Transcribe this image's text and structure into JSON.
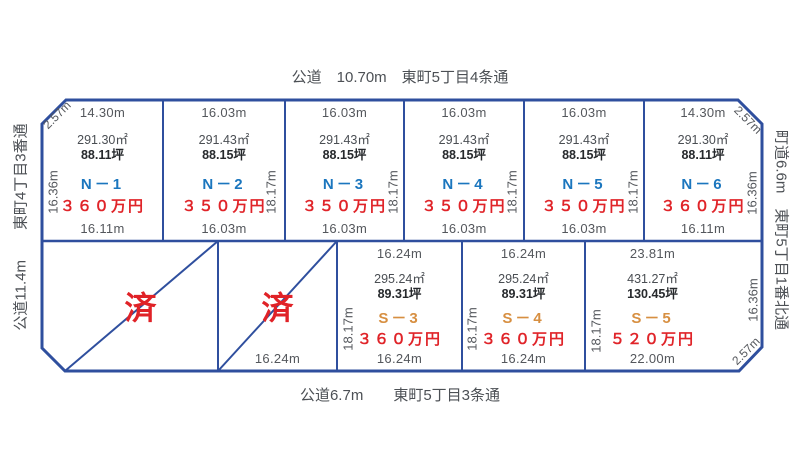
{
  "roads": {
    "top": "公道　10.70m　東町5丁目4条通",
    "bottom": "公道6.7m　　東町5丁目3条通",
    "left": "公道11.4m　　東町4丁目3番通",
    "right": "町道6.6m　東町5丁目1番北通"
  },
  "corners": {
    "top_left": "2.57m",
    "top_right": "2.57m",
    "bottom_right": "2.57m"
  },
  "north_plots": [
    {
      "id": "N－1",
      "price": "３６０万円",
      "area": "291.30㎡",
      "tsubo": "88.11坪",
      "top_dim": "14.30m",
      "bottom_dim": "16.11m",
      "side_dim": "16.36m"
    },
    {
      "id": "N－2",
      "price": "３５０万円",
      "area": "291.43㎡",
      "tsubo": "88.15坪",
      "top_dim": "16.03m",
      "bottom_dim": "16.03m",
      "side_dim": "18.17m"
    },
    {
      "id": "N－3",
      "price": "３５０万円",
      "area": "291.43㎡",
      "tsubo": "88.15坪",
      "top_dim": "16.03m",
      "bottom_dim": "16.03m",
      "side_dim": "18.17m"
    },
    {
      "id": "N－4",
      "price": "３５０万円",
      "area": "291.43㎡",
      "tsubo": "88.15坪",
      "top_dim": "16.03m",
      "bottom_dim": "16.03m",
      "side_dim": "18.17m"
    },
    {
      "id": "N－5",
      "price": "３５０万円",
      "area": "291.43㎡",
      "tsubo": "88.15坪",
      "top_dim": "16.03m",
      "bottom_dim": "16.03m",
      "side_dim": "18.17m"
    },
    {
      "id": "N－6",
      "price": "３６０万円",
      "area": "291.30㎡",
      "tsubo": "88.11坪",
      "top_dim": "14.30m",
      "bottom_dim": "16.11m",
      "side_dim": "16.36m"
    }
  ],
  "south_plots": [
    {
      "id": "S－3",
      "price": "３６０万円",
      "area": "295.24㎡",
      "tsubo": "89.31坪",
      "top_dim": "16.24m",
      "bottom_dim": "16.24m",
      "side_dim": "18.17m"
    },
    {
      "id": "S－4",
      "price": "３６０万円",
      "area": "295.24㎡",
      "tsubo": "89.31坪",
      "top_dim": "16.24m",
      "bottom_dim": "16.24m",
      "side_dim": "18.17m"
    },
    {
      "id": "S－5",
      "price": "５２０万円",
      "area": "431.27㎡",
      "tsubo": "130.45坪",
      "top_dim": "23.81m",
      "bottom_dim": "22.00m",
      "side_dim": "18.17m",
      "right_dim": "16.36m"
    }
  ],
  "sold_plots": [
    {
      "label": "済"
    },
    {
      "label": "済",
      "bottom_dim": "16.24m"
    }
  ],
  "colors": {
    "border_blue": "#2f4f9e",
    "north_id_blue": "#1b76be",
    "south_id_orange": "#d78f41",
    "price_red": "#e02429",
    "sold_red": "#e02227",
    "dim_gray": "#54575c"
  }
}
